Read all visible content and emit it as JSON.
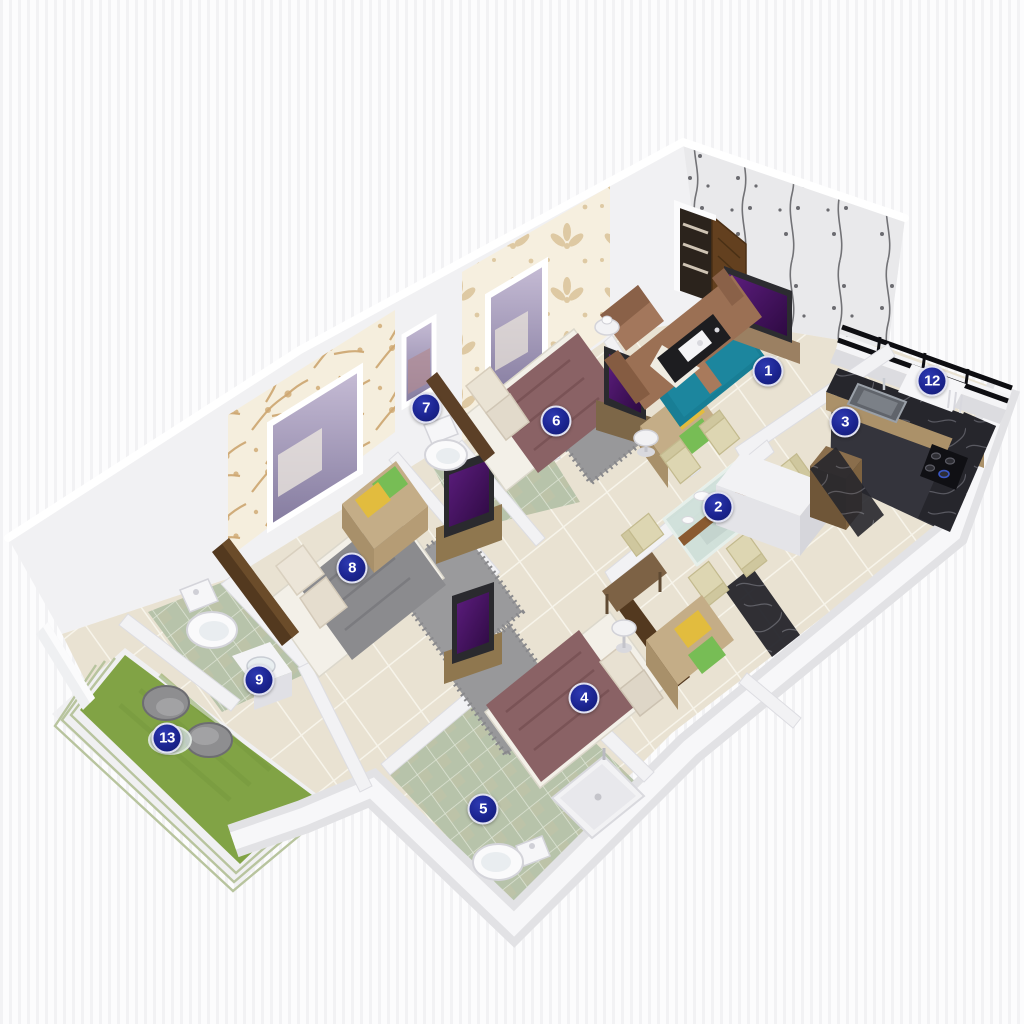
{
  "figure": {
    "kind": "isometric-3d-floor-plan-render",
    "description": "3D cutaway floor plan of an apartment with numbered blue room markers"
  },
  "markers": [
    {
      "label": "1",
      "x": 768,
      "y": 371
    },
    {
      "label": "2",
      "x": 718,
      "y": 507
    },
    {
      "label": "3",
      "x": 845,
      "y": 422
    },
    {
      "label": "4",
      "x": 584,
      "y": 698
    },
    {
      "label": "5",
      "x": 483,
      "y": 809
    },
    {
      "label": "6",
      "x": 556,
      "y": 421
    },
    {
      "label": "7",
      "x": 426,
      "y": 408
    },
    {
      "label": "8",
      "x": 352,
      "y": 568
    },
    {
      "label": "9",
      "x": 259,
      "y": 680
    },
    {
      "label": "12",
      "x": 932,
      "y": 381
    },
    {
      "label": "13",
      "x": 167,
      "y": 738
    }
  ],
  "palette": {
    "marker_blue": "#1b2490",
    "wall_white": "#f3f3f5",
    "floor_cream": "#e9e2d2",
    "bath_tile_green": "#b7c3aa",
    "grass_green": "#81a345",
    "bed_mauve": "#8a6265",
    "bed_gray": "#8c8c8f",
    "tv_purple": "#4a1166",
    "door_brown": "#5f3c22",
    "sofa_brown": "#9b7054",
    "rug_teal": "#187e95",
    "towel_yellow": "#e2bc3e",
    "towel_green": "#77bd55",
    "counter_black": "#26262c"
  }
}
